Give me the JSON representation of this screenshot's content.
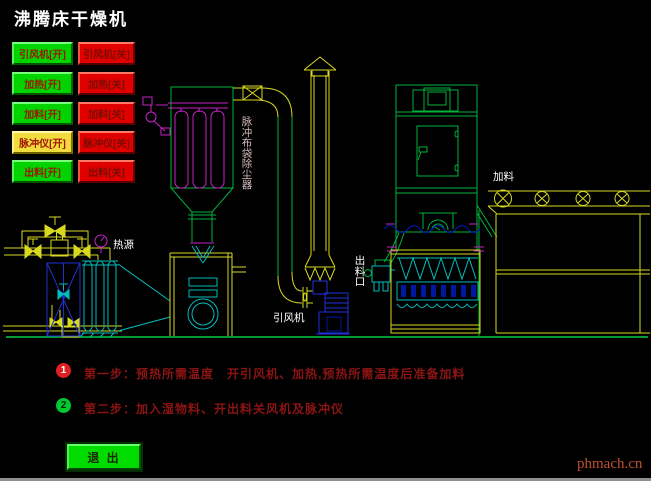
{
  "title": "沸腾床干燥机",
  "theme": {
    "background": "#000000",
    "button_green": "#00d400",
    "button_red": "#e00000",
    "button_yellow": "#f0dc3c",
    "button_text_red": "#a01400",
    "line_green": "#00b33c",
    "line_yellow": "#d8d820",
    "line_magenta": "#c822c8",
    "line_cyan": "#00bcbc",
    "line_blue": "#2030e0",
    "step_text_color": "#8c1414",
    "watermark_color": "#c05030"
  },
  "control_buttons": [
    {
      "label": "引风机[开]",
      "color": "green"
    },
    {
      "label": "引风机[关]",
      "color": "red"
    },
    {
      "label": "加热[开]",
      "color": "green"
    },
    {
      "label": "加热[关]",
      "color": "red"
    },
    {
      "label": "加料[开]",
      "color": "green"
    },
    {
      "label": "加料[关]",
      "color": "red"
    },
    {
      "label": "脉冲仪[开]",
      "color": "yellow"
    },
    {
      "label": "脉冲仪[关]",
      "color": "red"
    },
    {
      "label": "出料[开]",
      "color": "green"
    },
    {
      "label": "出料[关]",
      "color": "red"
    }
  ],
  "diagram_labels": {
    "dust_collector": "脉冲布袋除尘器",
    "heat_source": "热源",
    "induced_draft_fan": "引风机",
    "discharge_port": "出料口",
    "feed": "加料"
  },
  "steps": [
    {
      "num": "1",
      "text": "第一步：预热所需温度　开引风机、加热,预热所需温度后准备加料"
    },
    {
      "num": "2",
      "text": "第二步：加入湿物料、开出料关风机及脉冲仪"
    }
  ],
  "exit_button_label": "退 出",
  "watermark": "phmach.cn"
}
